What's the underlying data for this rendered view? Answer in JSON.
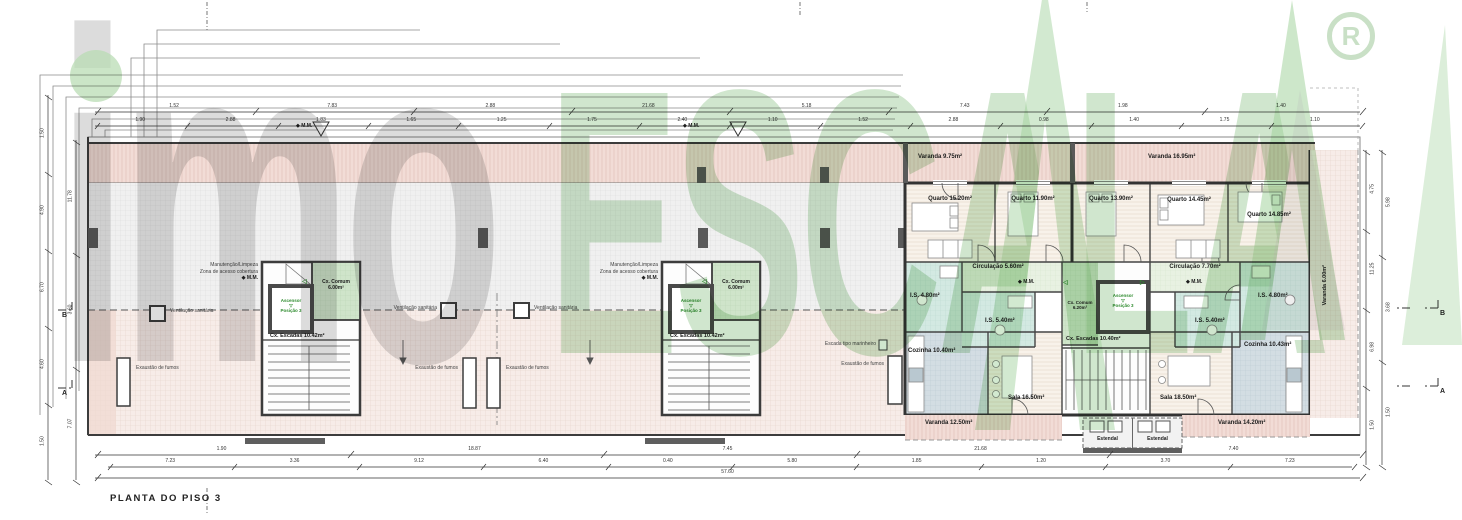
{
  "title": {
    "text": "PLANTA DO PISO 3"
  },
  "watermark": {
    "brand_gray": "imo",
    "brand_green": "ESCALA",
    "registered": "R"
  },
  "colors": {
    "watermark_green": "#8fc48a",
    "watermark_gray": "#ababab",
    "terrace_pink": "#f2dcd6",
    "bath_teal": "#d3e9e2",
    "plan_green": "#cfe4ca"
  },
  "annotations": {
    "ventilacao": "Ventilação sanitária",
    "exaustao": "Exaustão de fumos",
    "marinheiro": "Escada tipo marinheiro",
    "manutencao": "Manutenção/Limpeza",
    "zona_acesso": "Zona de acesso cobertura",
    "mm_marker": "◆ M.M.",
    "estendal": "Estendal"
  },
  "icons": {
    "elev_triangle": "▽",
    "door_left": "◁",
    "door_right": "▷"
  },
  "cores_roof": {
    "comum": "Cx. Comum",
    "comum_area": "6.00m²",
    "escadas": "Cx. Escadas 10.42m²",
    "ascensor": "Ascensor",
    "posicao": "Posição 3"
  },
  "core_central": {
    "comum": "Cx. Comum",
    "comum_area": "6.20m²",
    "escadas": "Cx. Escadas 10.40m²",
    "ascensor": "Ascensor",
    "posicao": "Posição 3"
  },
  "apt_left": {
    "varanda_top": "Varanda 9.75m²",
    "quarto1": "Quarto 15.20m²",
    "quarto2": "Quarto 11.90m²",
    "circulacao": "Circulação 5.60m²",
    "is1": "I.S. 4.80m²",
    "is2": "I.S. 5.40m²",
    "cozinha": "Cozinha 10.40m²",
    "sala": "Sala 16.50m²",
    "varanda_bottom": "Varanda 12.50m²"
  },
  "apt_right": {
    "varanda_top": "Varanda 16.95m²",
    "quarto1": "Quarto 13.90m²",
    "quarto2": "Quarto 14.45m²",
    "quarto3": "Quarto 14.85m²",
    "circulacao": "Circulação 7.70m²",
    "is1": "I.S. 5.40m²",
    "is2": "I.S. 4.80m²",
    "cozinha": "Cozinha 10.43m²",
    "sala": "Sala 18.50m²",
    "varanda_bottom": "Varanda 14.20m²",
    "varanda_side": "Varanda 6.00m²"
  },
  "section_markers": {
    "a": "A",
    "b": "B"
  },
  "dims": {
    "top1": [
      "1.52",
      "7.83",
      "2.88",
      "21.68",
      "5.18",
      "7.43",
      "1.98",
      "1.40"
    ],
    "top2": [
      "1.90",
      "2.88",
      "1.83",
      "1.65",
      "1.25",
      "1.75",
      "2.40",
      "1.10",
      "1.52",
      "2.88",
      "0.98",
      "1.40",
      "1.75",
      "1.10"
    ],
    "bottom1": [
      "1.90",
      "18.87",
      "7.45",
      "21.68",
      "7.40"
    ],
    "bottom2": [
      "7.23",
      "3.36",
      "9.12",
      "6.40",
      "0.40",
      "5.80",
      "1.85",
      "1.20",
      "3.70",
      "7.23"
    ],
    "bottom_total": "57.60",
    "left1": [
      "1.50",
      "4.90",
      "6.70",
      "4.60",
      "1.50"
    ],
    "left2": [
      "11.78",
      "3.60",
      "7.07"
    ],
    "right1": [
      "4.75",
      "11.25",
      "6.98",
      "1.50"
    ],
    "right2": [
      "5.98",
      "3.68",
      "1.50"
    ]
  }
}
